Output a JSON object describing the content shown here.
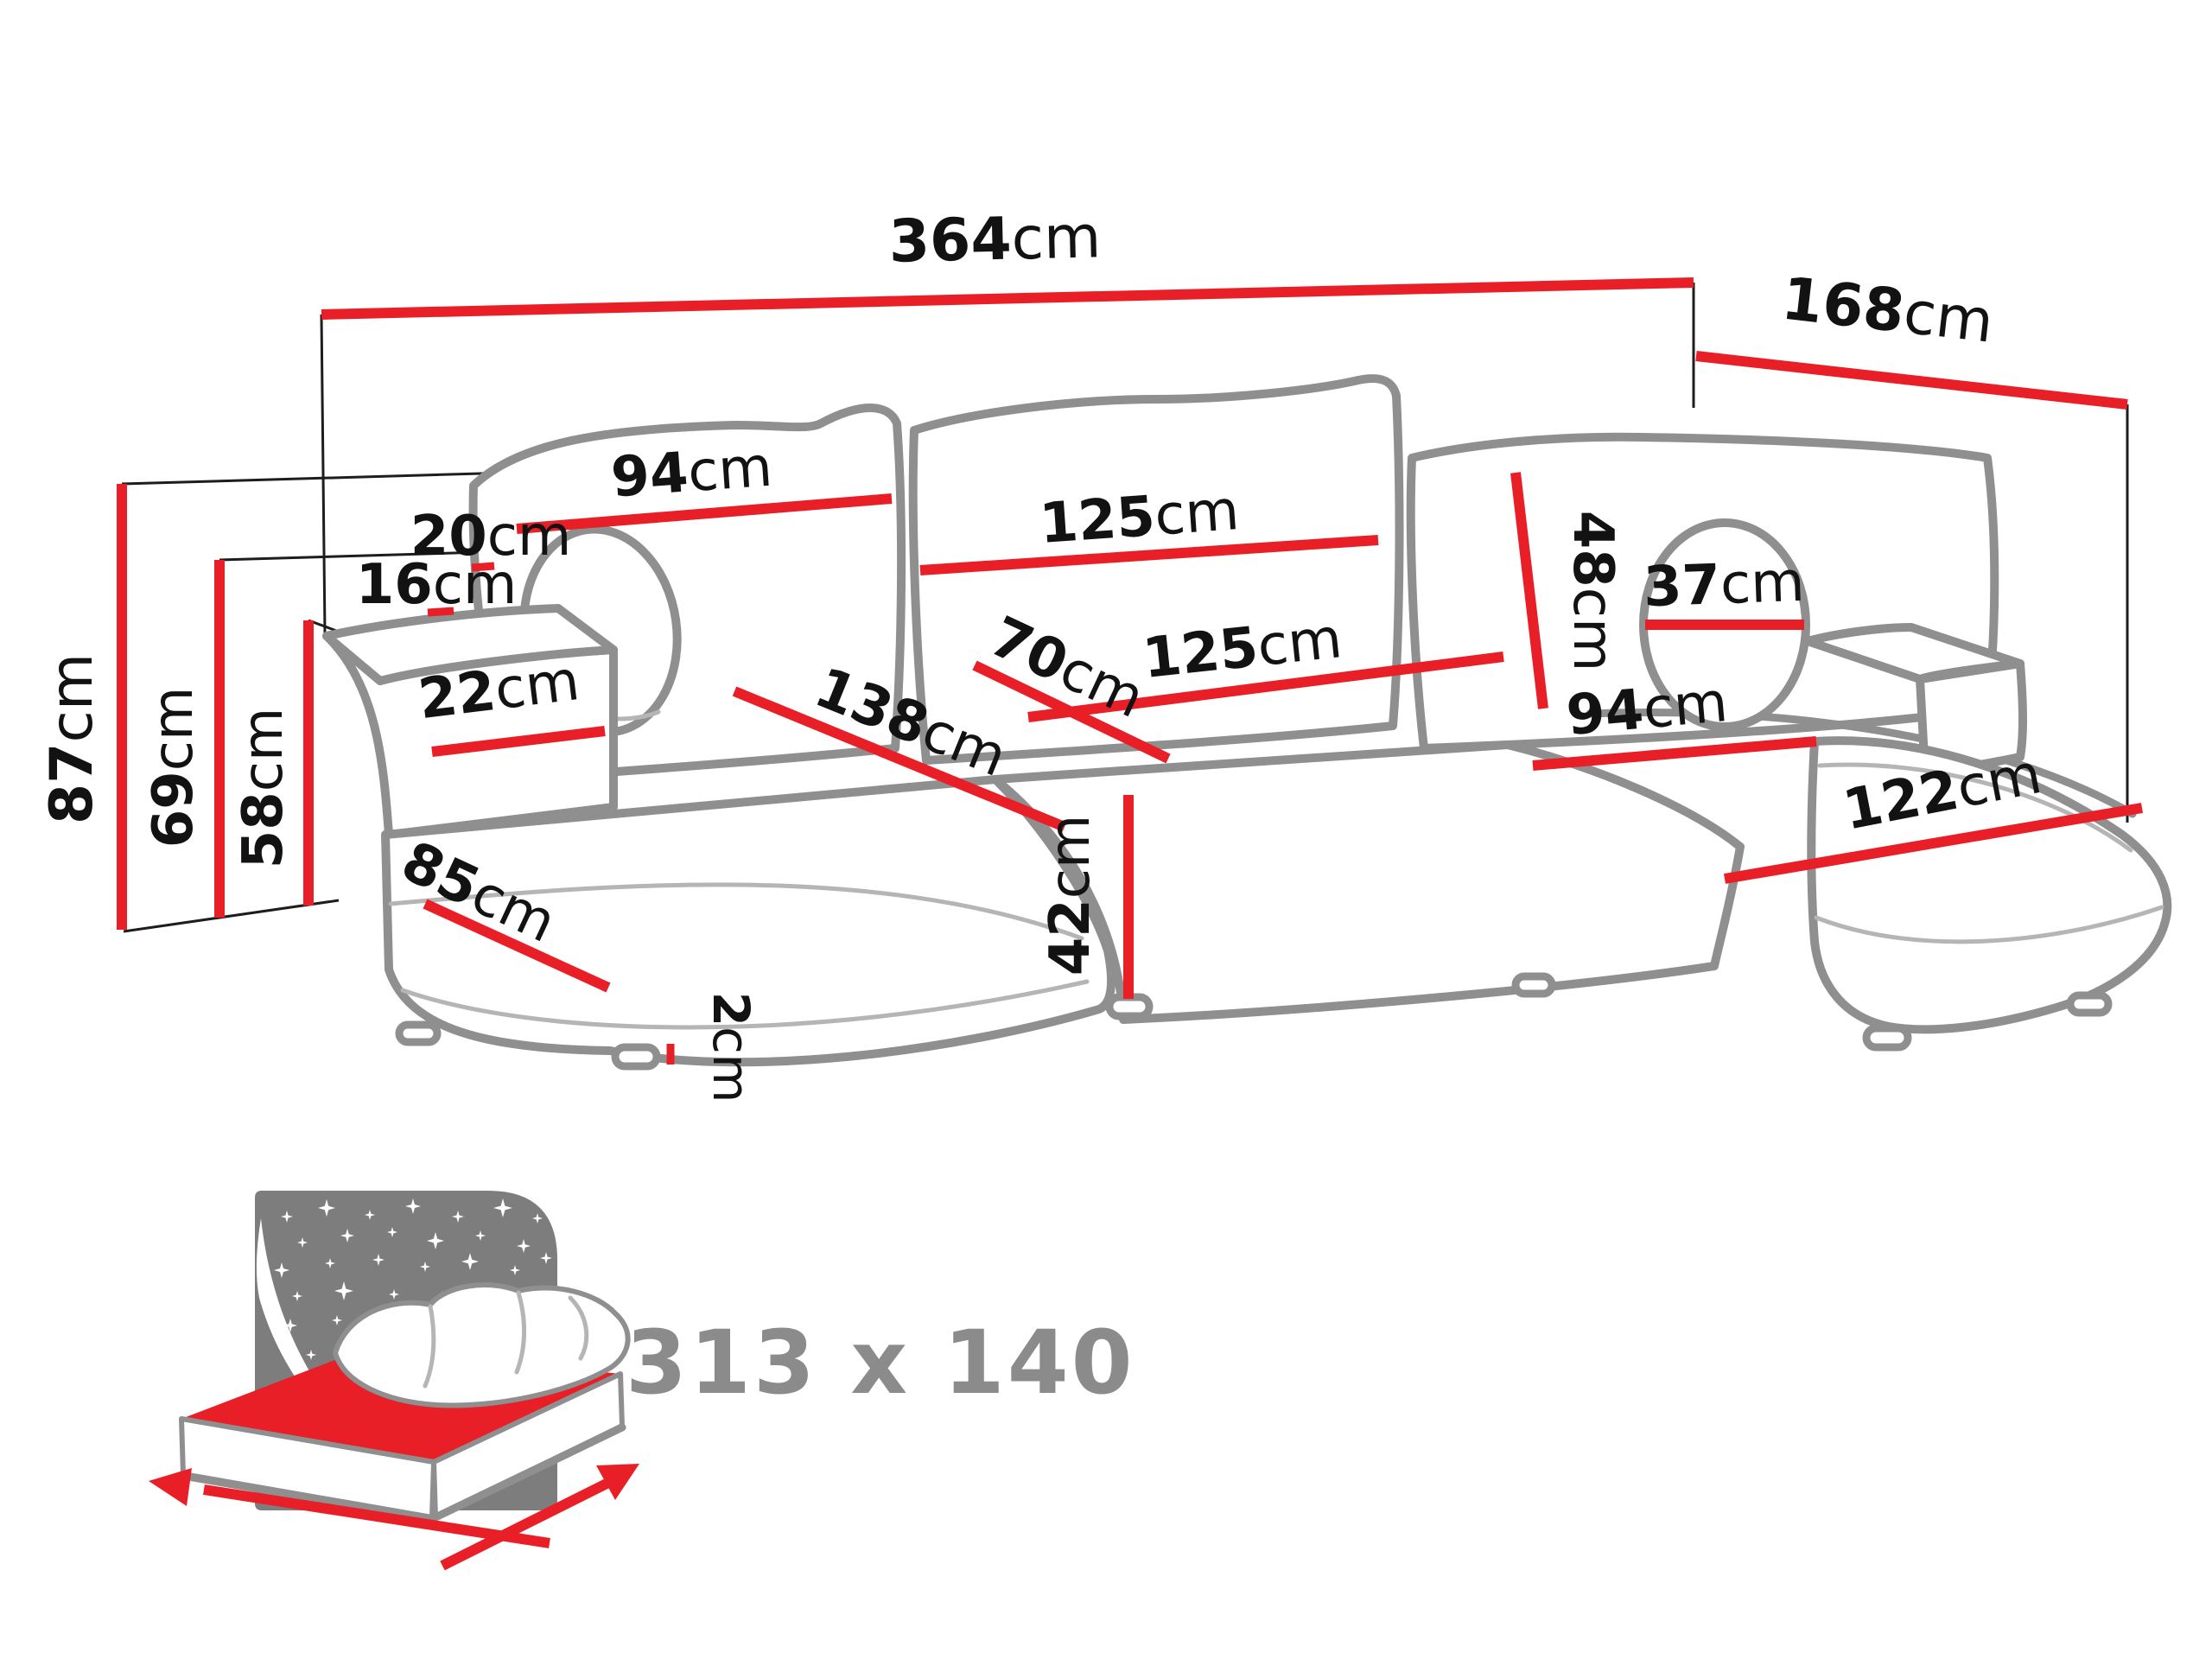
{
  "figure": {
    "type": "sofa-dimension-diagram",
    "unit": "cm",
    "accent_color": "#e81f26",
    "outline_color": "#8f8f8f",
    "text_color": "#121212",
    "icon_gray": "#7d7d7d"
  },
  "measurements": {
    "total_width": {
      "value": "364",
      "unit": "cm"
    },
    "total_depth": {
      "value": "168",
      "unit": "cm"
    },
    "backrest_left_width": {
      "value": "94",
      "unit": "cm"
    },
    "backrest_middle_width": {
      "value": "125",
      "unit": "cm"
    },
    "pillow_gap_upper": {
      "value": "20",
      "unit": "cm"
    },
    "pillow_gap_lower": {
      "value": "16",
      "unit": "cm"
    },
    "backrest_right_height": {
      "value": "48",
      "unit": "cm"
    },
    "bolster_diameter": {
      "value": "37",
      "unit": "cm"
    },
    "armrest_width": {
      "value": "22",
      "unit": "cm"
    },
    "seat_left_diagonal": {
      "value": "138",
      "unit": "cm"
    },
    "seat_middle_depth": {
      "value": "70",
      "unit": "cm"
    },
    "seat_middle_width": {
      "value": "125",
      "unit": "cm"
    },
    "seat_right_width": {
      "value": "94",
      "unit": "cm"
    },
    "chaise_left_side": {
      "value": "85",
      "unit": "cm"
    },
    "chaise_right_length": {
      "value": "122",
      "unit": "cm"
    },
    "total_height": {
      "value": "87",
      "unit": "cm"
    },
    "backrest_height": {
      "value": "69",
      "unit": "cm"
    },
    "armrest_height": {
      "value": "58",
      "unit": "cm"
    },
    "seat_height": {
      "value": "42",
      "unit": "cm"
    },
    "leg_height": {
      "value": "2",
      "unit": "cm"
    }
  },
  "sleeping_area": {
    "label": "313 x 140"
  }
}
